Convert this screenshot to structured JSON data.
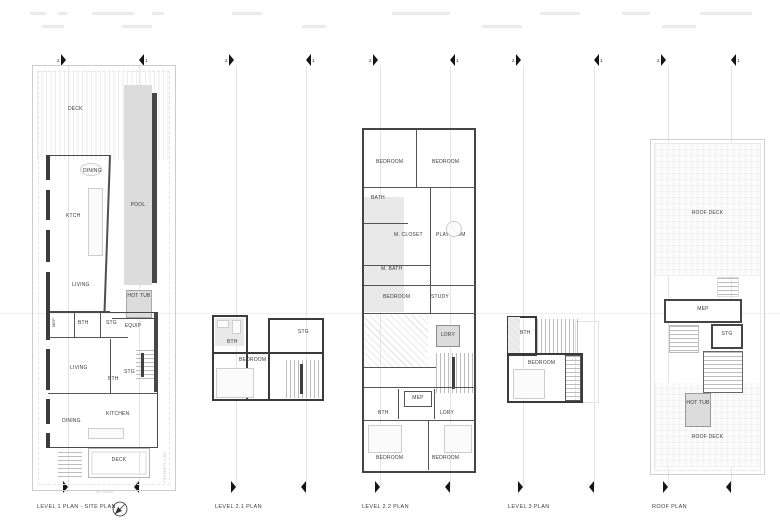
{
  "grid_markers": {
    "numbers": [
      "2",
      "1",
      "2",
      "1",
      "2",
      "1",
      "2",
      "1",
      "2",
      "1"
    ]
  },
  "plan1": {
    "caption": "LEVEL 1 PLAN - SITE PLAN",
    "deck_top": "DECK",
    "dining_upper": "DINING",
    "kitchen_upper": "KTCH",
    "pool": "POOL",
    "living_upper": "LIVING",
    "hot_tub": "HOT TUB",
    "equip": "EQUIP",
    "mep": "MEP",
    "bath_mid": "BTH",
    "storage_mid": "STG",
    "living_lower": "LIVING",
    "storage_lower": "STG",
    "bath_lower": "BTH",
    "dining_lower": "DINING",
    "kitchen_lower": "KITCHEN",
    "deck_bottom": "DECK",
    "property_line": "PROPERTY LINE",
    "setback": "SETBACK"
  },
  "plan2": {
    "caption": "LEVEL 2.1 PLAN",
    "bath": "BTH",
    "storage": "STG",
    "bedroom": "BEDROOM"
  },
  "plan3": {
    "caption": "LEVEL 2.2 PLAN",
    "bedroom_tl": "BEDROOM",
    "bedroom_tr": "BEDROOM",
    "bath": "BATH",
    "m_closet": "M. CLOSET",
    "playroom": "PLAYROOM",
    "m_bath": "M. BATH",
    "bedroom_mid": "BEDROOM",
    "study": "STUDY",
    "laundry_mid": "LDRY",
    "mep": "MEP",
    "bath_lower": "BTH",
    "laundry_lower": "LDRY",
    "bedroom_bl": "BEDROOM",
    "bedroom_br": "BEDROOM"
  },
  "plan4": {
    "caption": "LEVEL 3 PLAN",
    "bath": "BTH",
    "bedroom": "BEDROOM"
  },
  "plan5": {
    "caption": "ROOF PLAN",
    "roof_deck_top": "ROOF DECK",
    "mep": "MEP",
    "storage": "STG",
    "hot_tub": "HOT TUB",
    "roof_deck_bottom": "ROOF DECK"
  }
}
